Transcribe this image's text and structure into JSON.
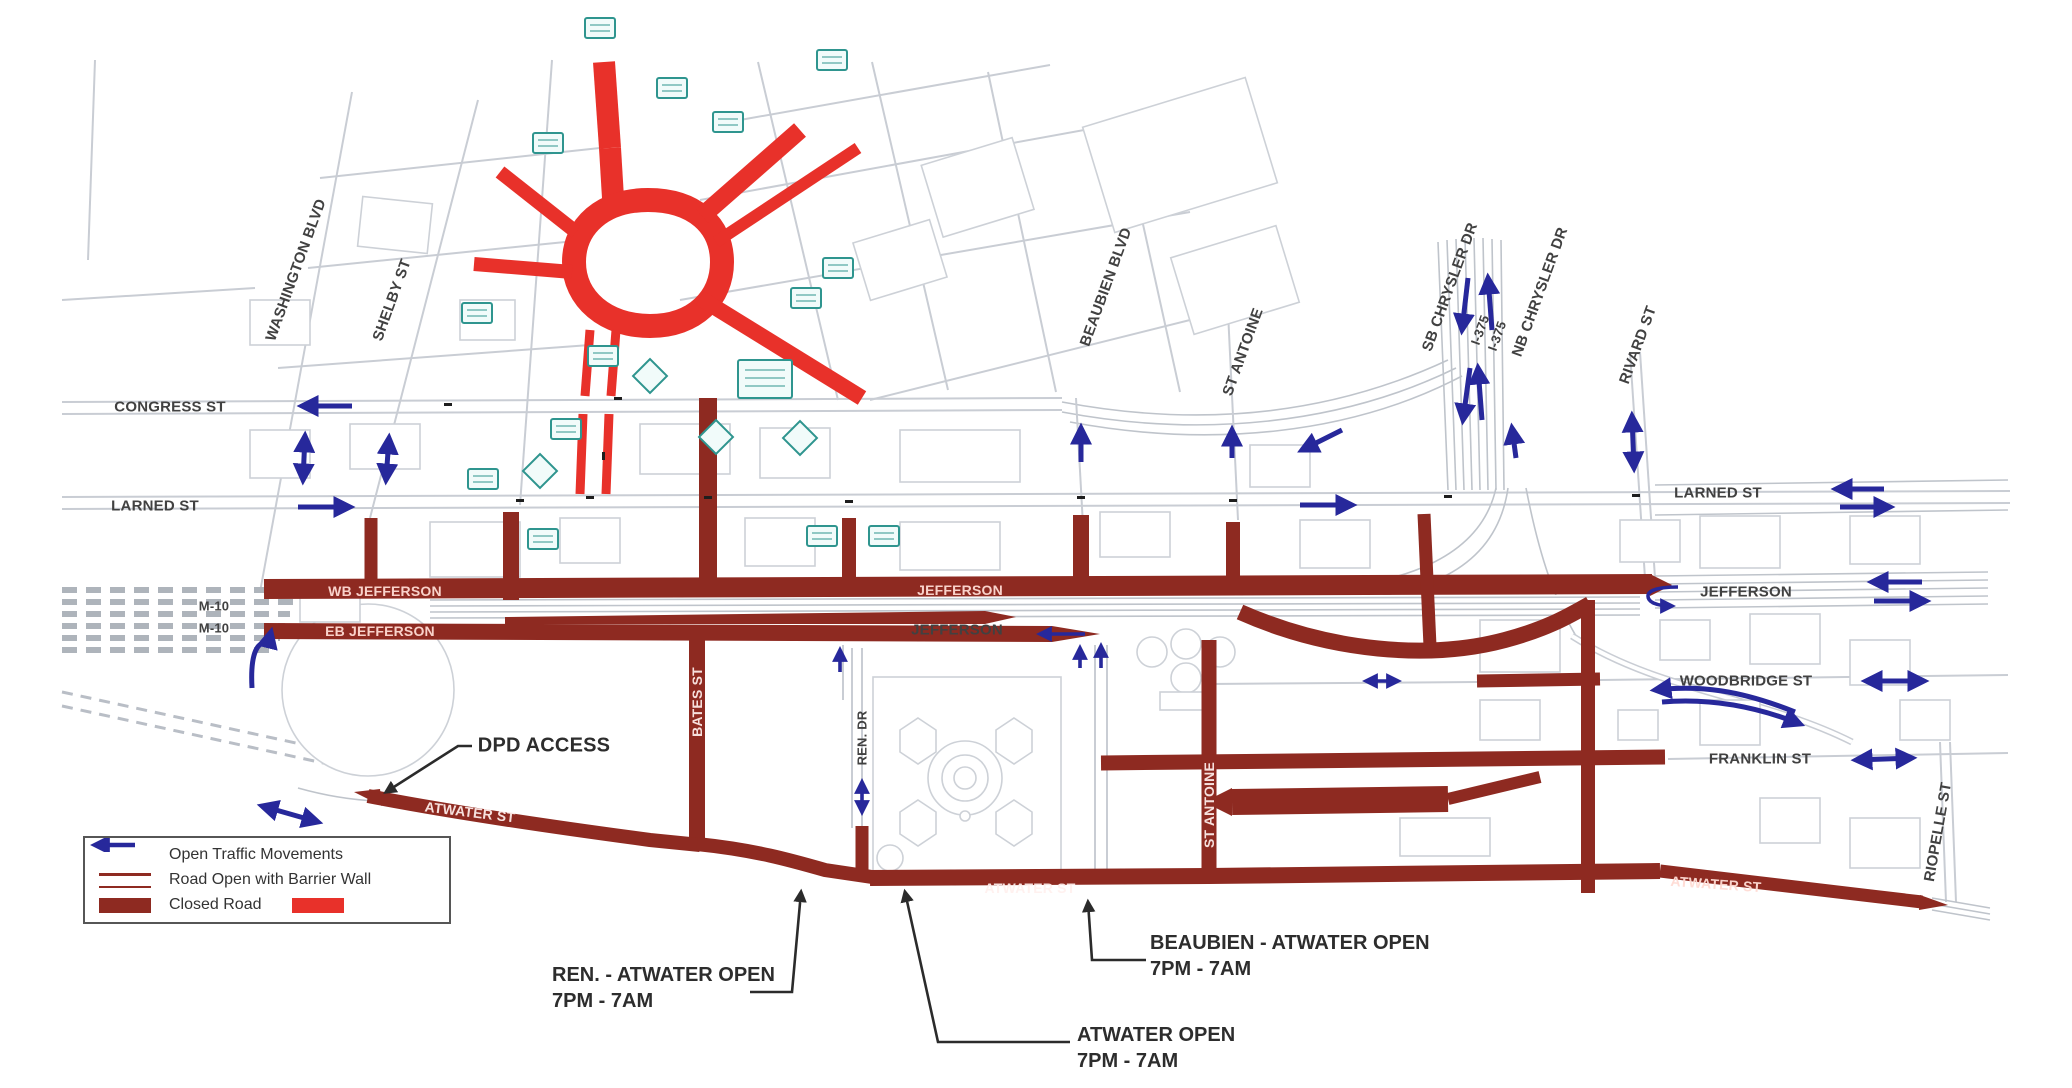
{
  "title": "Downtown road closure map",
  "colors": {
    "closed_road": "#8e2a21",
    "closed_road_bright": "#e8312a",
    "open_arrow": "#27289b",
    "sign_teal": "#2f958f",
    "background_street": "#c9cdd4",
    "leader": "#2b2b2b"
  },
  "legend": {
    "items": [
      {
        "label": "Open Traffic Movements"
      },
      {
        "label": "Road Open with Barrier Wall"
      },
      {
        "label": "Closed Road"
      }
    ]
  },
  "labels": {
    "washington_blvd": "WASHINGTON BLVD",
    "shelby_st": "SHELBY ST",
    "congress_st": "CONGRESS ST",
    "larned_st_left": "LARNED ST",
    "m10_a": "M-10",
    "m10_b": "M-10",
    "wb_jefferson": "WB JEFFERSON",
    "eb_jefferson": "EB JEFFERSON",
    "jefferson_center_closed": "JEFFERSON",
    "jefferson_center_open": "JEFFERSON",
    "beaubien_blvd": "BEAUBIEN BLVD",
    "st_antoine_upper": "ST ANTOINE",
    "sb_chrysler": "SB CHRYSLER DR",
    "i375_a": "I-375",
    "i375_b": "I-375",
    "nb_chrysler": "NB CHRYSLER DR",
    "rivard_st": "RIVARD ST",
    "larned_st_right": "LARNED ST",
    "jefferson_right": "JEFFERSON",
    "woodbridge_st": "WOODBRIDGE ST",
    "franklin_st": "FRANKLIN ST",
    "riopelle_st": "RIOPELLE ST",
    "atwater_st_west": "ATWATER ST",
    "atwater_st_center": "ATWATER ST",
    "atwater_st_east": "ATWATER ST",
    "bates_st": "BATES ST",
    "ren_dr": "REN. DR",
    "st_antoine_lower": "ST ANTOINE",
    "dpd_access": "DPD ACCESS"
  },
  "annotations": {
    "ren_atwater": {
      "line1": "REN. - ATWATER OPEN",
      "line2": "7PM - 7AM"
    },
    "atwater": {
      "line1": "ATWATER OPEN",
      "line2": "7PM - 7AM"
    },
    "beaubien_atwater": {
      "line1": "BEAUBIEN - ATWATER OPEN",
      "line2": "7PM - 7AM"
    }
  }
}
